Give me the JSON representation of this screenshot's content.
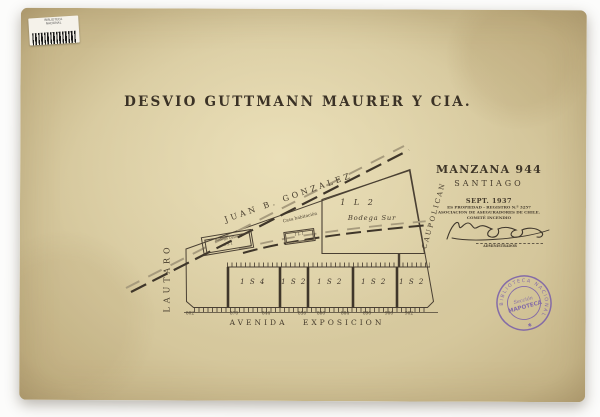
{
  "barcode": {
    "label": "BIBLIOTECA NACIONAL"
  },
  "title": "DESVIO GUTTMANN MAURER Y CIA.",
  "title_block": {
    "manzana": "MANZANA 944",
    "city": "SANTIAGO",
    "date": "SEPT. 1937",
    "property_line1": "ES PROPIEDAD - REGISTRO N.º 3257",
    "property_line2": "ASOCIACION DE ASEGURADORES DE CHILE.",
    "property_line3": "COMITÉ INCENDIO",
    "signer_role": "ADMINISTRADOR"
  },
  "map": {
    "street_top": "JUAN B. GONZALEZ",
    "street_left": "LAUTARO",
    "street_right": "CAUPOLICAN",
    "street_bottom": "AVENIDA EXPOSICION",
    "bodega_oriente_name": "Bodega Oriente",
    "bodega_oriente_code": "1 S 1",
    "casa_name": "Casa habitación",
    "casa_code": "1 L 1",
    "big_lot_code": "1 L 2",
    "big_lot_name": "Bodega Sur",
    "row_lots": [
      "1 S 4",
      "1 S 2",
      "1 S 2",
      "1 S 2",
      "1 S 2"
    ],
    "street_numbers": [
      "802",
      "870",
      "844",
      "856",
      "860",
      "884",
      "890",
      "900",
      "902"
    ]
  },
  "stamp": {
    "ring": "BIBLIOTECA NACIONAL",
    "star": "✱",
    "line1": "Sección",
    "line2": "MAPOTECA"
  },
  "colors": {
    "paper": "#d8cba0",
    "ink": "#453b2c",
    "stamp": "#7459ab"
  }
}
